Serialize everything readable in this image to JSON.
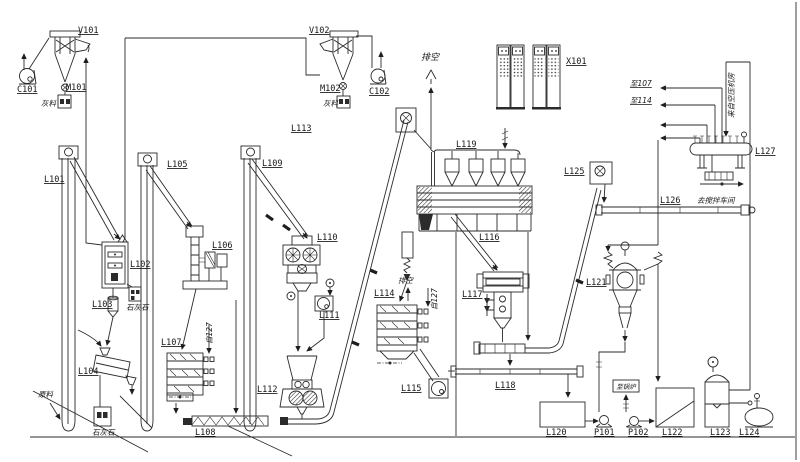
{
  "diagram": {
    "type": "process-flow-diagram",
    "colors": {
      "line": "#2b2b2b",
      "background": "#ffffff"
    },
    "labels": {
      "c101": "C101",
      "v101": "V101",
      "m101": "M101",
      "v102": "V102",
      "m102": "M102",
      "c102": "C102",
      "x101": "X101",
      "l101": "L101",
      "l102": "L102",
      "l103": "L103",
      "l104": "L104",
      "l105": "L105",
      "l106": "L106",
      "l107": "L107",
      "l108": "L108",
      "l109": "L109",
      "l110": "L110",
      "l111": "L111",
      "l112": "L112",
      "l113": "L113",
      "l114": "L114",
      "l115": "L115",
      "l116": "L116",
      "l117": "L117",
      "l118": "L118",
      "l119": "L119",
      "l120": "L120",
      "l121": "L121",
      "l122": "L122",
      "l123": "L123",
      "l124": "L124",
      "l125": "L125",
      "l126": "L126",
      "l127": "L127",
      "p101": "P101",
      "p102": "P102"
    },
    "annotations": {
      "vent_top": "排空",
      "vent_small": "排空",
      "to_107": "至107",
      "to_114": "至114",
      "from_127_a": "自127",
      "from_127_b": "自127",
      "raw_material": "原料",
      "limestone_a": "石灰石",
      "limestone_b": "石灰石",
      "dust_a": "灰料",
      "dust_b": "灰料",
      "to_boiler": "至锅炉",
      "to_mixing_room": "去搅拌车间",
      "from_air_compressor": "来自空压机房"
    }
  }
}
